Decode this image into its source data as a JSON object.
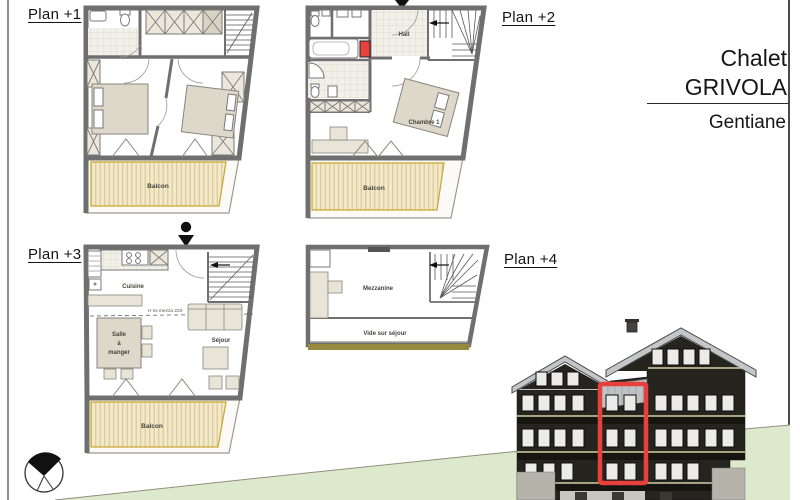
{
  "title_block": {
    "name_line1": "Chalet",
    "name_line2": "GRIVOLA",
    "unit": "Gentiane"
  },
  "plan_labels": {
    "p1": "Plan +1",
    "p2": "Plan +2",
    "p3": "Plan +3",
    "p4": "Plan +4"
  },
  "rooms": {
    "p1": {
      "balcony": "Balcon"
    },
    "p2": {
      "hall": "Hall",
      "bedroom": "Chambre 1",
      "balcony": "Balcon"
    },
    "p3": {
      "kitchen": "Cuisine",
      "dining_lines": [
        "Salle",
        "à",
        "manger"
      ],
      "living": "Séjour",
      "balcony": "Balcon",
      "height_note": "H ss mezza 220"
    },
    "p4": {
      "mezzanine": "Mezzanine",
      "void": "Vide sur séjour"
    }
  },
  "colors": {
    "accent_red": "#e8403c",
    "hill_green": "#dde9cc",
    "plan_floor": "#efece2",
    "decking": "#f3e8c8",
    "wall_gray": "#6f6f6f",
    "facade_dark": "#26241f",
    "roof_gray": "#c3c7c9"
  },
  "icons": {
    "compass": "north-compass-icon",
    "entrance": "entrance-marker-icon"
  }
}
